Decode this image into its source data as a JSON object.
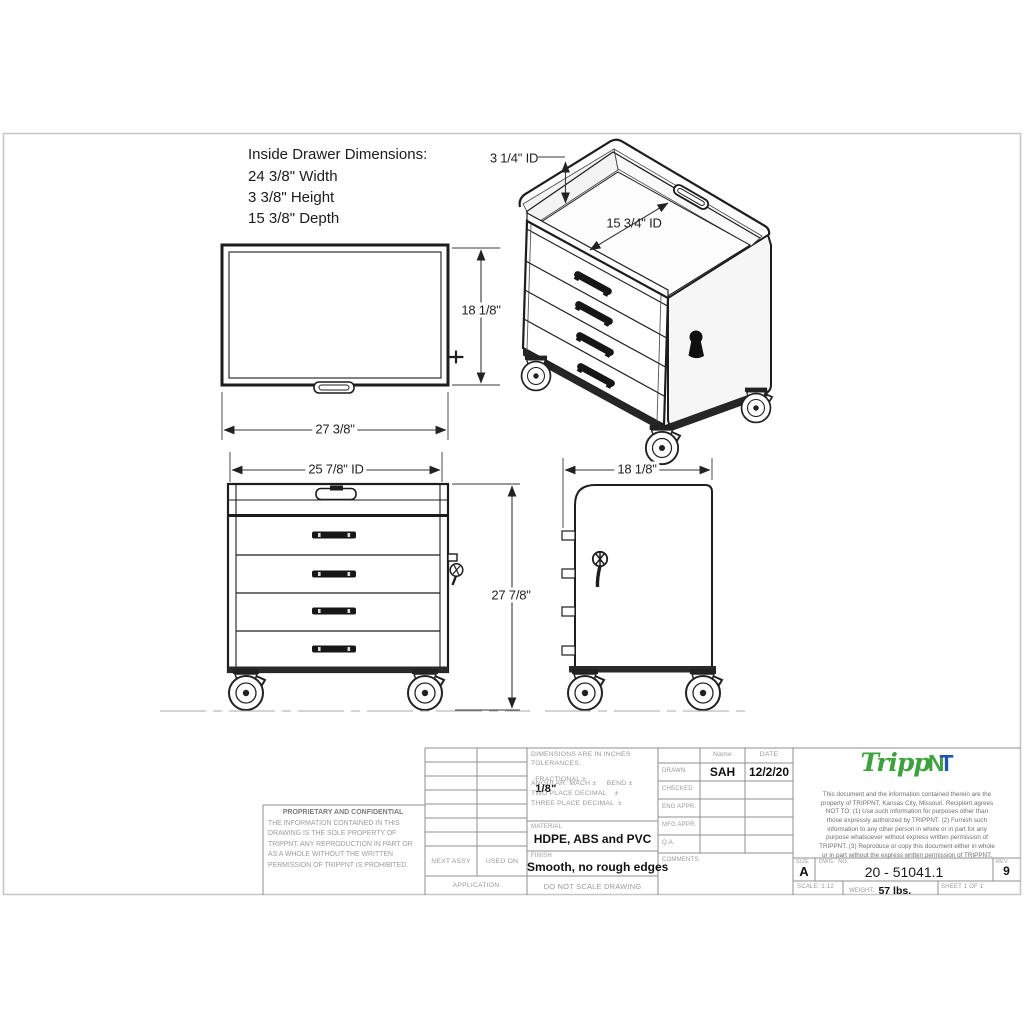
{
  "drawing": {
    "inside_dims": {
      "title": "Inside Drawer Dimensions:",
      "width": "24 3/8\" Width",
      "height": "3 3/8\" Height",
      "depth": "15 3/8\" Depth"
    },
    "dims": {
      "top_height": "18 1/8\"",
      "top_width": "27 3/8\"",
      "front_inner_width": "25 7/8\" ID",
      "front_height": "27 7/8\"",
      "side_width": "18 1/8\"",
      "iso_tray_depth": "3 1/4\" ID",
      "iso_tray_width": "15 3/4\" ID"
    }
  },
  "title_block": {
    "proprietary": {
      "title": "PROPRIETARY AND CONFIDENTIAL",
      "body": "THE INFORMATION CONTAINED IN THIS DRAWING IS THE SOLE PROPERTY OF TRIPPNT.  ANY REPRODUCTION IN PART OR AS A WHOLE WITHOUT THE WRITTEN PERMISSION OF TRIPPNT IS PROHIBITED."
    },
    "application": {
      "next_assy": "NEXT ASSY",
      "used_on": "USED ON",
      "application": "APPLICATION"
    },
    "tolerances": {
      "line1": "DIMENSIONS ARE IN INCHES",
      "line2": "TOLERANCES:",
      "fractional_label": "FRACTIONAL ±",
      "fractional_value": "1/8\"",
      "line4": "ANGULAR: MACH ±     BEND ±",
      "line5": "TWO PLACE DECIMAL    ±",
      "line6": "THREE PLACE DECIMAL  ±"
    },
    "material_label": "MATERIAL",
    "material_value": "HDPE, ABS and PVC",
    "finish_label": "FINISH",
    "finish_value": "Smooth, no rough edges",
    "do_not_scale": "DO NOT SCALE DRAWING",
    "signoff": {
      "name_header": "Name",
      "date_header": "DATE",
      "rows": [
        {
          "label": "DRAWN",
          "name": "SAH",
          "date": "12/2/20"
        },
        {
          "label": "CHECKED",
          "name": "",
          "date": ""
        },
        {
          "label": "ENG APPR.",
          "name": "",
          "date": ""
        },
        {
          "label": "MFG APPR.",
          "name": "",
          "date": ""
        },
        {
          "label": "Q.A.",
          "name": "",
          "date": ""
        }
      ],
      "comments_label": "COMMENTS:"
    },
    "logo": {
      "part1": "Tripp",
      "part2": "N",
      "part3": "T",
      "green": "#3da23d",
      "blue": "#1f55b0"
    },
    "legal": "This document and the information contained therein are the property of TRIPPNT, Kansas City, Missouri. Recipient agrees NOT TO: (1) Use such information for purposes other than those expressly authorized by TRIPPNT. (2) Furnish such information to any other person in whole or in part for any purpose whatsoever without express  written permission of TRIPPNT. (3) Reproduce or copy this document either in whole or in part without the express written permission of TRIPPNT.",
    "size_label": "SIZE",
    "size_value": "A",
    "dwg_label": "DWG.  NO.",
    "dwg_value": "20 - 51041.1",
    "rev_label": "REV.",
    "rev_value": "9",
    "scale_text": "SCALE: 1:12",
    "weight_label": "WEIGHT:",
    "weight_value": "57 lbs.",
    "sheet_text": "SHEET 1 OF 1"
  }
}
